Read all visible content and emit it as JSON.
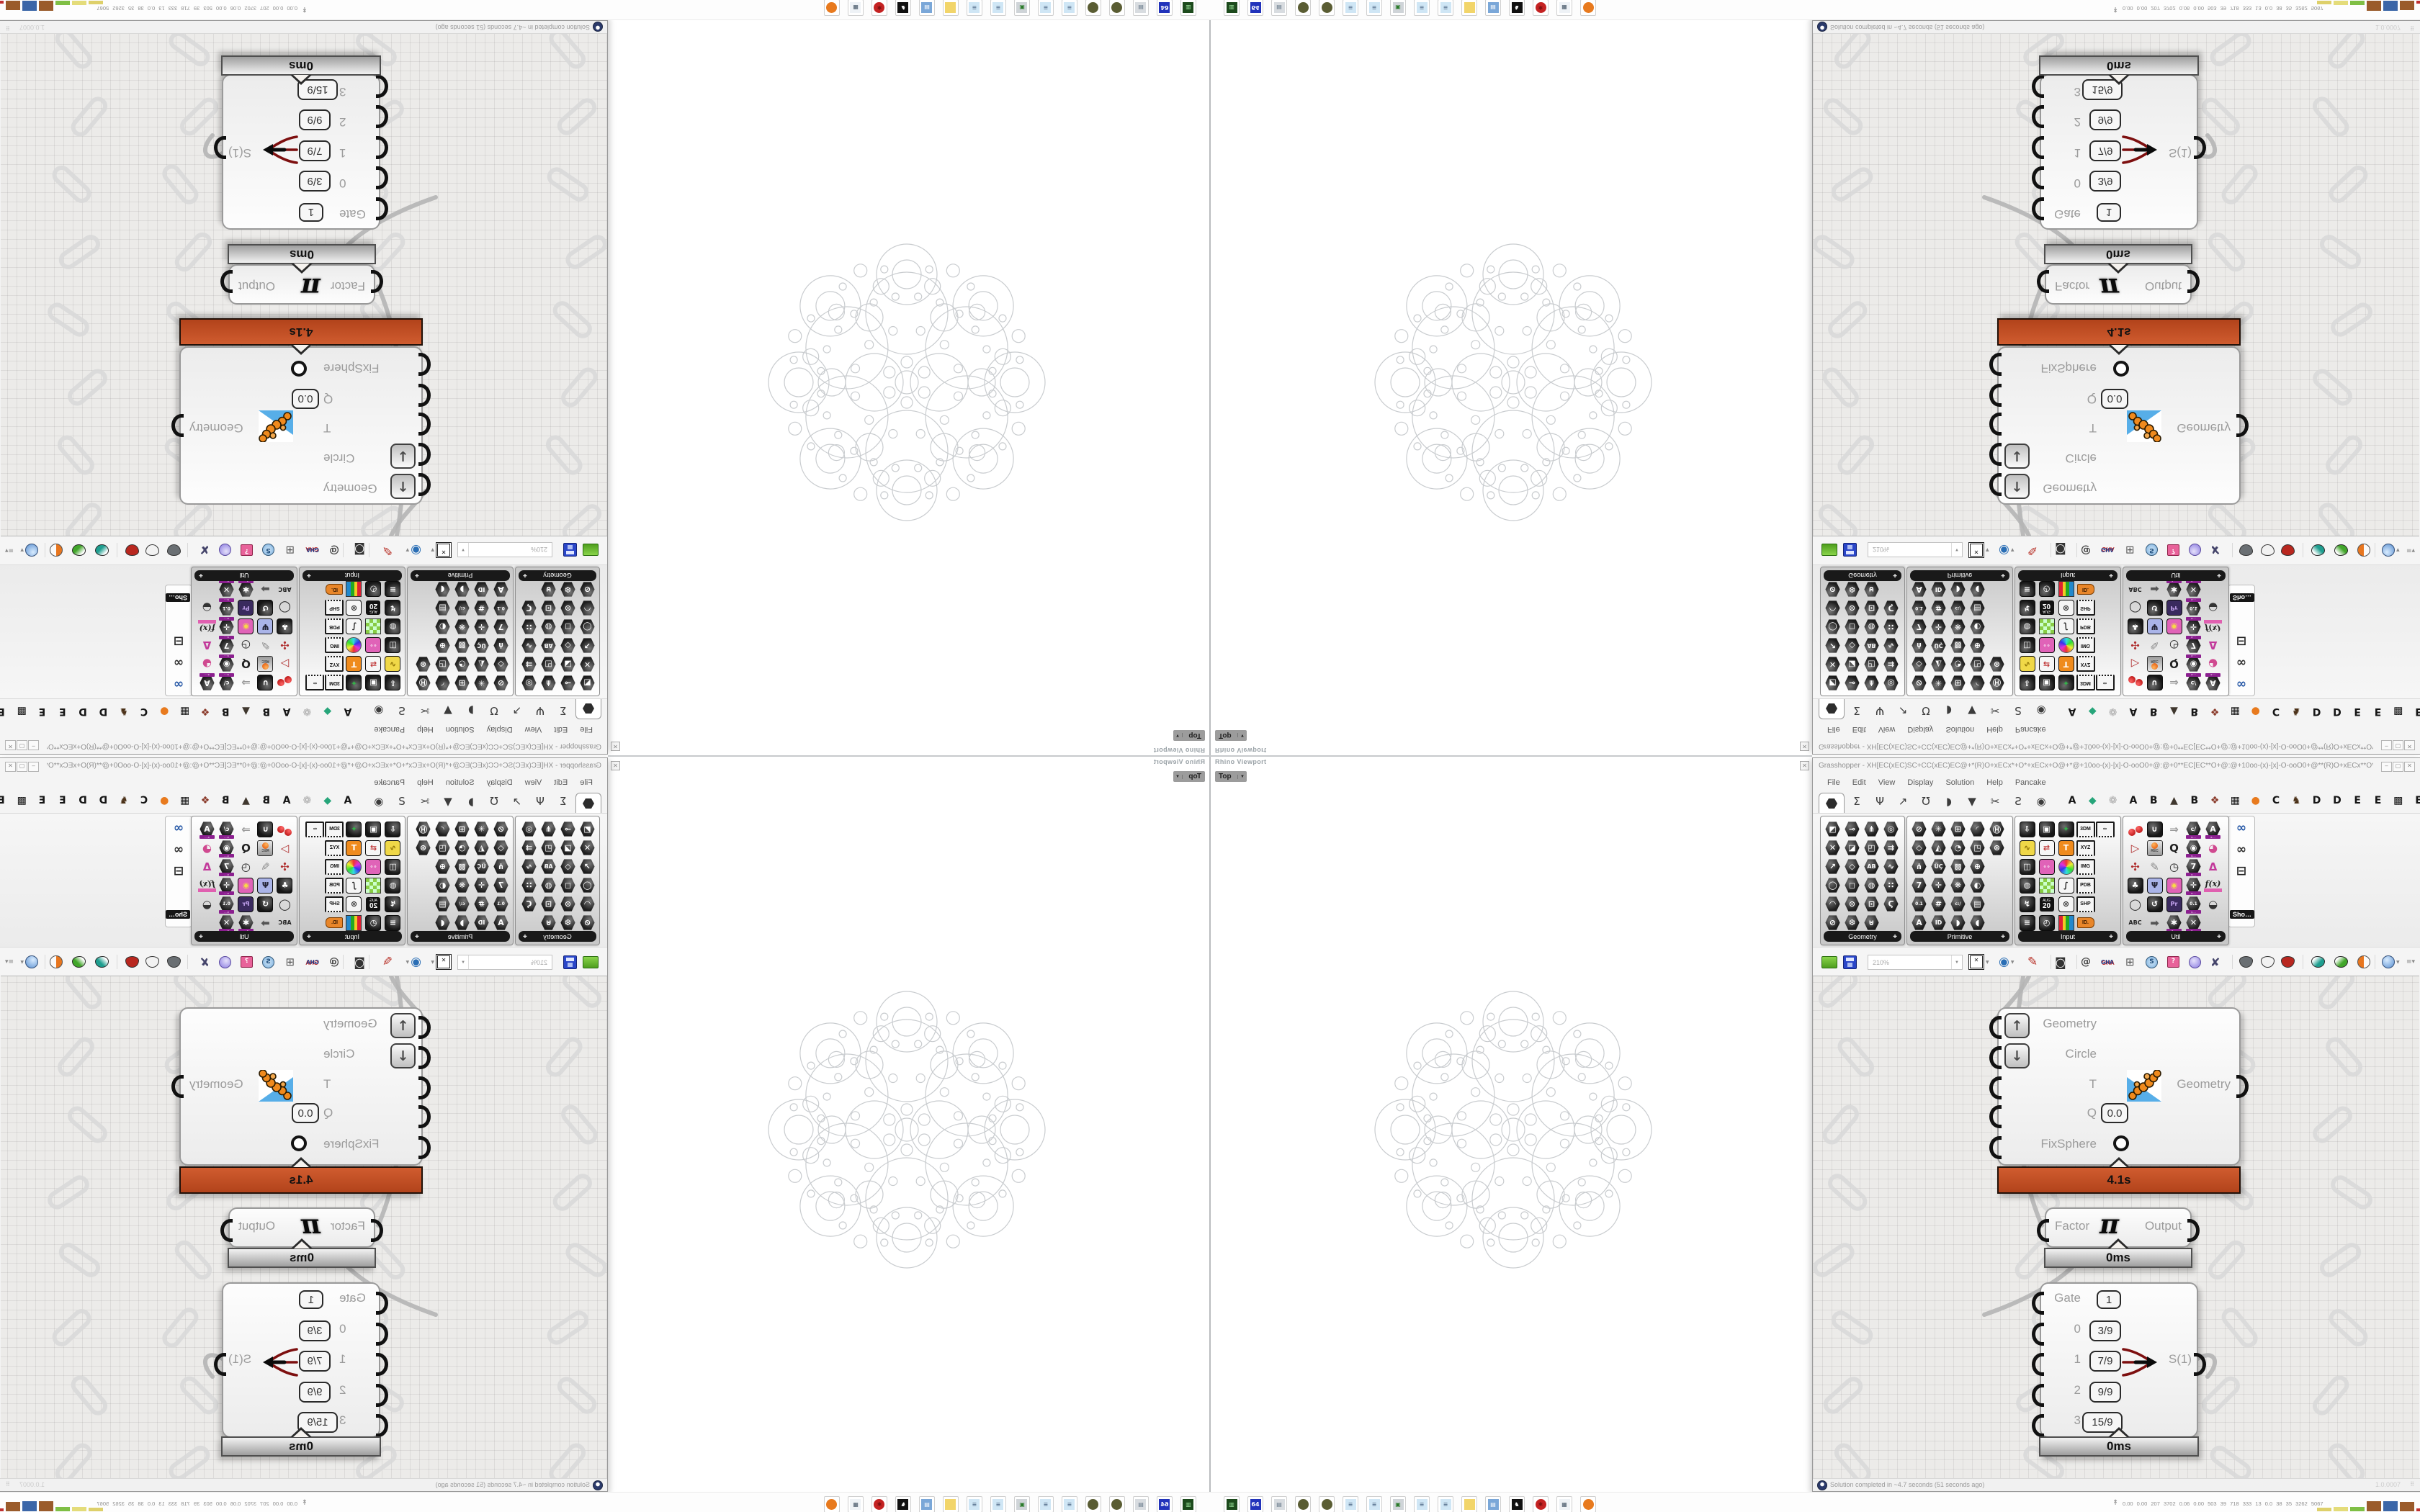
{
  "viewport": {
    "panel_title": "Rhino Viewport",
    "view_tab": "Top",
    "close_glyph": "x",
    "fractal_rings": [
      {
        "n": 8,
        "R": 150,
        "r": 42,
        "a": 0
      },
      {
        "n": 8,
        "R": 150,
        "r": 20,
        "a": 0
      },
      {
        "n": 8,
        "R": 168,
        "r": 9,
        "a": 22.5
      },
      {
        "n": 6,
        "R": 96,
        "r": 57,
        "a": 30
      },
      {
        "n": 2,
        "R": 45,
        "r": 40,
        "a": 0
      },
      {
        "n": 1,
        "R": 0,
        "r": 16,
        "a": 0
      },
      {
        "n": 6,
        "R": 28,
        "r": 8,
        "a": 90
      },
      {
        "n": 6,
        "R": 104,
        "r": 19,
        "a": 0
      },
      {
        "n": 12,
        "R": 138,
        "r": 11,
        "a": 15
      },
      {
        "n": 12,
        "R": 74,
        "r": 6,
        "a": 15
      },
      {
        "n": 24,
        "R": 120,
        "r": 5,
        "a": 7.5
      },
      {
        "n": 16,
        "R": 160,
        "r": 5,
        "a": 11.25
      }
    ]
  },
  "gh": {
    "title": "Grasshopper - XH[EC(xEC)SC+CC(xEC)EC@+*(R)O+xECx*+O*+xECx+O@+*@+10oo-(x)-[x]-O-ooO0+@:@+0**EC[EC**O+@:@+10oo-(x)-[x]-O-ooO0+@**(R)O+xECx**O**...",
    "window_buttons": {
      "minimize": "_",
      "maximize": "口",
      "close": "X"
    },
    "menus": [
      "File",
      "Edit",
      "View",
      "Display",
      "Solution",
      "Help",
      "Pancake"
    ],
    "tabs": {
      "icon_glyphs": [
        "Σ",
        "Ψ",
        "↗",
        "Ʊ",
        "◗",
        "▼",
        "✂",
        "Ƨ",
        "◉"
      ],
      "plugin_tabs": [
        [
          "A",
          "#151515"
        ],
        [
          "◆",
          "#27a57a"
        ],
        [
          "❁",
          "#a9a9a9"
        ],
        [
          "A",
          "#151515"
        ],
        [
          "B",
          "#151515"
        ],
        [
          "▲",
          "#3f372e"
        ],
        [
          "B",
          "#151515"
        ],
        [
          "❖",
          "#8a3a2a"
        ],
        [
          "▦",
          "#151515"
        ],
        [
          "●",
          "#e87a1e"
        ],
        [
          "C",
          "#151515"
        ],
        [
          "♞",
          "#4a3017"
        ],
        [
          "D",
          "#151515"
        ],
        [
          "D",
          "#151515"
        ],
        [
          "E",
          "#151515"
        ],
        [
          "E",
          "#151515"
        ],
        [
          "▩",
          "#151515"
        ],
        [
          "E",
          "#151515"
        ]
      ]
    },
    "palette": {
      "groups": [
        {
          "label": "Geometry",
          "rows": [
            [
              {
                "g": "◩"
              },
              {
                "g": "⊸"
              },
              {
                "g": "⋔"
              },
              {
                "g": "◎"
              }
            ],
            [
              {
                "g": "✕"
              },
              {
                "g": "◪"
              },
              {
                "g": "◰"
              },
              {
                "g": "⇉"
              }
            ],
            [
              {
                "g": "↗"
              },
              {
                "g": "◇"
              },
              {
                "g": "AB"
              },
              {
                "g": "∿"
              }
            ],
            [
              {
                "g": "◯"
              },
              {
                "g": "◻"
              },
              {
                "g": "◍"
              },
              {
                "g": "∷"
              }
            ],
            [
              {
                "g": "◠"
              },
              {
                "g": "⊙"
              },
              {
                "g": "⊡"
              },
              {
                "g": "Ϛ"
              }
            ],
            [
              {
                "g": "⊘"
              },
              {
                "g": "❆"
              },
              {
                "g": "⊍"
              }
            ]
          ]
        },
        {
          "label": "Primitive",
          "rows": [
            [
              {
                "g": "⊘"
              },
              {
                "g": "✳"
              },
              {
                "g": "⊞"
              },
              {
                "g": "◜"
              },
              {
                "g": "Ⓗ"
              }
            ],
            [
              {
                "g": "◇"
              },
              {
                "g": "◭"
              },
              {
                "g": "◔"
              },
              {
                "g": "◳"
              },
              {
                "g": "⊛"
              }
            ],
            [
              {
                "g": "⋔"
              },
              {
                "g": "ÜÇ"
              },
              {
                "g": "▩"
              },
              {
                "g": "⊕"
              }
            ],
            [
              {
                "g": "7"
              },
              {
                "g": "✛"
              },
              {
                "g": "❋"
              },
              {
                "g": "◐"
              }
            ],
            [
              {
                "g": "0.1"
              },
              {
                "g": "#"
              },
              {
                "g": "c:/"
              },
              {
                "g": "▤"
              }
            ],
            [
              {
                "g": "A"
              },
              {
                "g": "ID"
              },
              {
                "g": "◗"
              },
              {
                "g": "◖"
              }
            ]
          ]
        },
        {
          "label": "Input",
          "rows": [
            [
              {
                "g": "⇩",
                "t": "sq"
              },
              {
                "g": "▣",
                "t": "sq"
              },
              {
                "g": "✦",
                "t": "sq",
                "c": "#35b04a"
              },
              {
                "g": "3DM",
                "t": "st"
              },
              {
                "g": "∞",
                "t": "st"
              }
            ],
            [
              {
                "g": "∿",
                "t": "sq",
                "bg": "#f0d848",
                "c": "#8a6d00"
              },
              {
                "g": "⇄",
                "t": "sq",
                "bg": "#f6f6f6",
                "c": "#c03a3a"
              },
              {
                "g": "T",
                "t": "sq",
                "bg": "#ef8b1d"
              },
              {
                "g": "XYZ",
                "t": "st"
              }
            ],
            [
              {
                "g": "◫",
                "t": "sq"
              },
              {
                "g": "∘∘",
                "t": "sq",
                "bg": "#e063b8"
              },
              {
                "t": "rc"
              },
              {
                "g": "IMG",
                "t": "st"
              }
            ],
            [
              {
                "g": "◍",
                "t": "sq"
              },
              {
                "t": "gc"
              },
              {
                "g": "∫",
                "t": "sq",
                "bg": "#f6f6f6",
                "c": "#222"
              },
              {
                "g": "PDB",
                "t": "st"
              }
            ],
            [
              {
                "g": "↯",
                "t": "sq"
              },
              {
                "t": "cal",
                "top": "AUG",
                "bot": "20"
              },
              {
                "g": "⊚",
                "t": "sq",
                "bg": "#f6f6f6",
                "c": "#333"
              },
              {
                "g": "SHP",
                "t": "st"
              }
            ],
            [
              {
                "g": "≡",
                "t": "sq"
              },
              {
                "g": "◴",
                "t": "sq"
              },
              {
                "t": "rb"
              },
              {
                "g": "ID.",
                "t": "tag"
              }
            ]
          ]
        },
        {
          "label": "Util",
          "rows": [
            [
              {
                "t": "cherry"
              },
              {
                "g": "∪",
                "t": "sq"
              },
              {
                "g": "⇒",
                "t": "plain",
                "c": "#9a9a9a"
              },
              {
                "g": "c/",
                "ub": 1
              },
              {
                "g": "A",
                "ub": 1
              }
            ],
            [
              {
                "g": "▷",
                "t": "plain",
                "c": "#b03030"
              },
              {
                "t": "rec",
                "cap": "REC"
              },
              {
                "g": "Q",
                "t": "plain",
                "c": "#222"
              },
              {
                "g": "◉",
                "ub": 1
              },
              {
                "g": "◕",
                "t": "plain",
                "c": "#d04a90"
              }
            ],
            [
              {
                "g": "✣",
                "t": "plain",
                "c": "#b03030"
              },
              {
                "g": "✎",
                "t": "plain",
                "c": "#8a8a8a"
              },
              {
                "g": "◷",
                "t": "plain",
                "c": "#222"
              },
              {
                "g": "7",
                "ub": 1
              },
              {
                "g": "Δ",
                "t": "plain",
                "c": "#c2399a"
              }
            ],
            [
              {
                "g": "♣",
                "t": "sq"
              },
              {
                "g": "Ψ",
                "t": "sq",
                "bg": "#aab4e8",
                "c": "#223"
              },
              {
                "g": "◉",
                "t": "sq",
                "bg": "#e063b8",
                "c": "#f7d848"
              },
              {
                "g": "✛",
                "ub": 1
              },
              {
                "g": "f(x)",
                "t": "fx"
              }
            ],
            [
              {
                "g": "◯",
                "t": "plain",
                "c": "#222"
              },
              {
                "g": "↺",
                "t": "sq"
              },
              {
                "g": "Pr",
                "t": "sq",
                "bg": "#3a2a5e",
                "c": "#caa9f5"
              },
              {
                "g": "0.1",
                "ub": 1
              },
              {
                "g": "◒",
                "t": "plain",
                "c": "#333"
              }
            ],
            [
              {
                "g": "ABC",
                "t": "plain",
                "c": "#222"
              },
              {
                "g": "➡",
                "t": "plain",
                "c": "#555"
              },
              {
                "g": "✱",
                "ub": 1
              },
              {
                "g": "✕",
                "ub": 1
              }
            ]
          ]
        }
      ],
      "more_group": {
        "label": "Sho…",
        "icons": [
          [
            "∞",
            "#2456a5"
          ],
          [
            "∞",
            "#333333"
          ],
          [
            "⊟",
            "#222222"
          ]
        ]
      }
    },
    "toolbar": {
      "zoom_value": "210%"
    },
    "canvas": {
      "main": {
        "inputs": [
          {
            "label": "Geometry"
          },
          {
            "label": "Circle"
          },
          {
            "label": "T"
          },
          {
            "label": "Q",
            "value": "0.0"
          },
          {
            "label": "FixSphere"
          }
        ],
        "output": {
          "label": "Geometry"
        },
        "time": "4.1s"
      },
      "pi": {
        "input": "Factor",
        "glyph": "π",
        "output": "Output",
        "time": "0ms"
      },
      "select": {
        "rows": [
          {
            "label": "Gate",
            "value": "1"
          },
          {
            "label": "0",
            "value": "3/9"
          },
          {
            "label": "1",
            "value": "7/9"
          },
          {
            "label": "2",
            "value": "9/9"
          },
          {
            "label": "3",
            "value": "15/9"
          }
        ],
        "output": "S(1)",
        "time": "0ms"
      }
    },
    "status": {
      "text": "Solution completed in ~4.7 seconds (51 seconds ago)",
      "version": "1.0.0007"
    }
  },
  "taskbar": {
    "icons": [
      {
        "n": "drive-icon",
        "bg": "#1c4a1c",
        "g": "▥",
        "c": "#9fe89f"
      },
      {
        "n": "floppy64-icon",
        "bg": "#2233bb",
        "g": "64",
        "c": "#ffffff"
      },
      {
        "n": "printer-icon",
        "bg": "#d8dce0",
        "g": "▤",
        "c": "#667788"
      },
      {
        "n": "moss-ball-icon",
        "bg": "#5a5d33",
        "round": 1
      },
      {
        "n": "moss-ball-icon",
        "bg": "#5a5d33",
        "round": 1
      },
      {
        "n": "notepad-icon",
        "bg": "#cfe6f5",
        "g": "≡",
        "c": "#667f99"
      },
      {
        "n": "notepad-icon",
        "bg": "#cfe6f5",
        "g": "≡",
        "c": "#667f99"
      },
      {
        "n": "monitor-icon",
        "bg": "#cfd4d8",
        "g": "▣",
        "c": "#2a7a2a"
      },
      {
        "n": "notepad-icon",
        "bg": "#cfe6f5",
        "g": "≡",
        "c": "#667f99"
      },
      {
        "n": "notepad-icon",
        "bg": "#cfe6f5",
        "g": "≡",
        "c": "#667f99"
      },
      {
        "n": "folder-icon",
        "bg": "#f2d56a",
        "g": "",
        "c": "#a8862a"
      },
      {
        "n": "display-settings-icon",
        "bg": "#7aa7d8",
        "g": "▤",
        "c": "#ffffff"
      },
      {
        "n": "cat-icon",
        "bg": "#111111",
        "g": "♞",
        "c": "#ffffff"
      },
      {
        "n": "red-gear-icon",
        "bg": "#c42222",
        "g": "✱",
        "c": "#7a0f0f",
        "round": 1
      },
      {
        "n": "calculator-icon",
        "bg": "#eef2f6",
        "g": "▦",
        "c": "#445566"
      },
      {
        "n": "firefox-icon",
        "bg": "#e87a1e",
        "g": "",
        "c": "#5a2a8a",
        "round": 1
      }
    ],
    "stats_icon": "↟",
    "stats_text": "0.00 0.00 207 3702 0.06 0.00 503 39 718 333 13 0.0 38 35 3262 5067",
    "monitor_bars": [
      {
        "c": "#ded06a",
        "h": 5
      },
      {
        "c": "#e4dc7a",
        "h": 6
      },
      {
        "c": "#7fbf45",
        "h": 6
      },
      {
        "c": "#9a5b2b",
        "h": 14
      },
      {
        "c": "#3b66a8",
        "h": 14
      },
      {
        "c": "#9a5b2b",
        "h": 13
      },
      {
        "c": "#c03030",
        "h": 4,
        "w": 8
      },
      {
        "c": "#3aa53a",
        "h": 4,
        "w": 8
      }
    ]
  },
  "colors": {
    "profiler_orange": "#c4502a",
    "profiler_silver": "#c9c9c9",
    "ubar_purple": "#8b1f8f",
    "wire_gray": "#b5b5b5",
    "fractal_stroke": "#c9cccf"
  }
}
